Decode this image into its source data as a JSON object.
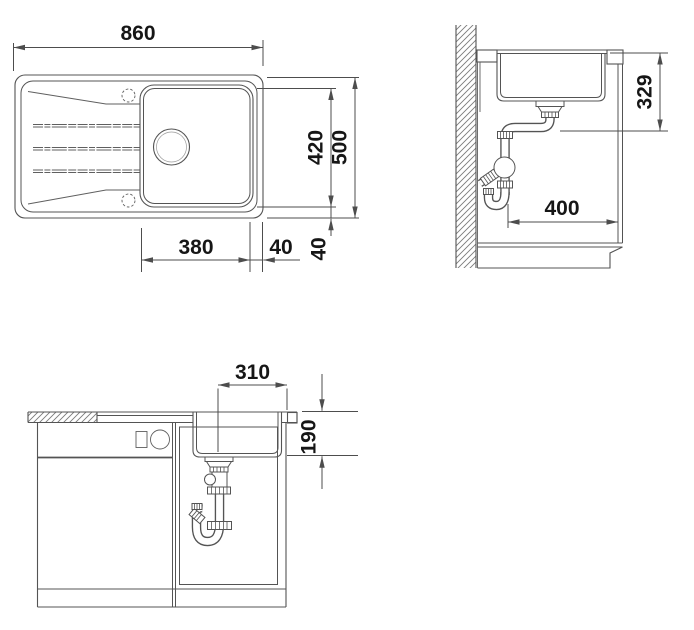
{
  "drawing": {
    "plan": {
      "dims": {
        "overall_width": "860",
        "bowl_length": "420",
        "overall_depth": "500",
        "bowl_width": "380",
        "bowl_to_side_edge": "40",
        "bowl_to_front_edge": "40"
      }
    },
    "side": {
      "dims": {
        "worktop_to_outlet": "329",
        "clearance_depth": "400"
      }
    },
    "front": {
      "dims": {
        "bowl_base_width": "310",
        "bowl_depth": "190"
      }
    },
    "colors": {
      "line": "#545454",
      "dimension": "#4d4d4d",
      "text": "#161616",
      "background": "#ffffff"
    }
  }
}
